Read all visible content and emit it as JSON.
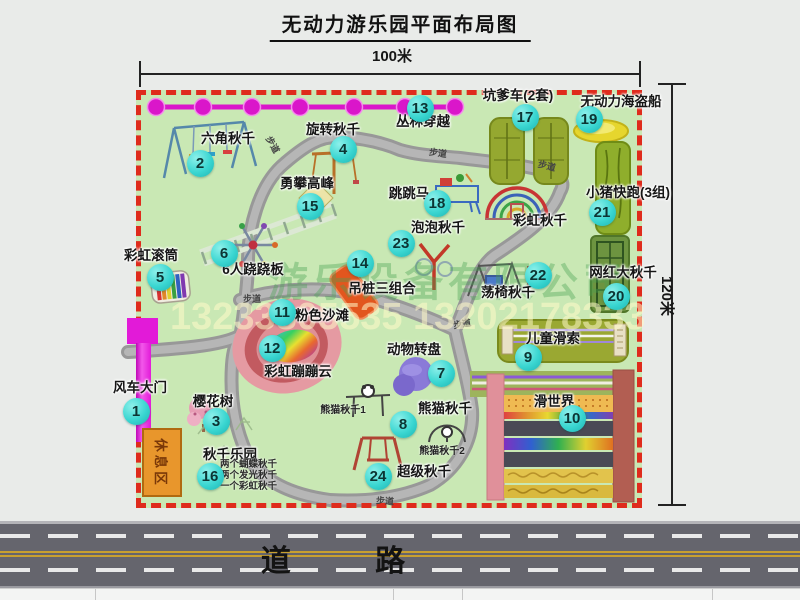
{
  "title": "无动力游乐园平面布局图",
  "dimensions": {
    "width": "100米",
    "height": "120米"
  },
  "road": {
    "label": "道 路"
  },
  "walkway_label": "步道",
  "rest_area_label": "休息区",
  "rainbow_swing_label": "彩虹秋千",
  "watermark": {
    "company": "游乐设备有限公司",
    "phone": "13233805535 13202178333"
  },
  "colors": {
    "badge": "#3ad6d1",
    "map_green": "#c9e8b4",
    "border_red": "#df2b1c",
    "zipline_magenta": "#da16ca",
    "gate_magenta": "#e21ad8",
    "rest_orange": "#e8962c"
  },
  "features": [
    {
      "num": "1",
      "label": "风车大门"
    },
    {
      "num": "2",
      "label": "六角秋千"
    },
    {
      "num": "3",
      "label": "樱花树"
    },
    {
      "num": "4",
      "label": "旋转秋千"
    },
    {
      "num": "5",
      "label": "彩虹滚筒"
    },
    {
      "num": "6",
      "label": "6人跷跷板"
    },
    {
      "num": "7",
      "label": "动物转盘"
    },
    {
      "num": "8",
      "label": "熊猫秋千",
      "sub": [
        "熊猫秋千1",
        "熊猫秋千2"
      ]
    },
    {
      "num": "9",
      "label": "儿童滑索"
    },
    {
      "num": "10",
      "label": "滑世界"
    },
    {
      "num": "11",
      "label": "粉色沙滩"
    },
    {
      "num": "12",
      "label": "彩虹蹦蹦云"
    },
    {
      "num": "13",
      "label": "丛林穿越"
    },
    {
      "num": "14",
      "label": "吊桩三组合"
    },
    {
      "num": "15",
      "label": "勇攀高峰"
    },
    {
      "num": "16",
      "label": "秋千乐园",
      "sub": [
        "两个蝴蝶秋千",
        "两个发光秋千",
        "一个彩虹秋千"
      ]
    },
    {
      "num": "17",
      "label": "坑爹车(2套)"
    },
    {
      "num": "18",
      "label": "跳跳马"
    },
    {
      "num": "19",
      "label": "无动力海盗船"
    },
    {
      "num": "20",
      "label": "网红大秋千"
    },
    {
      "num": "21",
      "label": "小猪快跑(3组)"
    },
    {
      "num": "22",
      "label": "荡椅秋千"
    },
    {
      "num": "23",
      "label": "泡泡秋千"
    },
    {
      "num": "24",
      "label": "超级秋千"
    }
  ]
}
